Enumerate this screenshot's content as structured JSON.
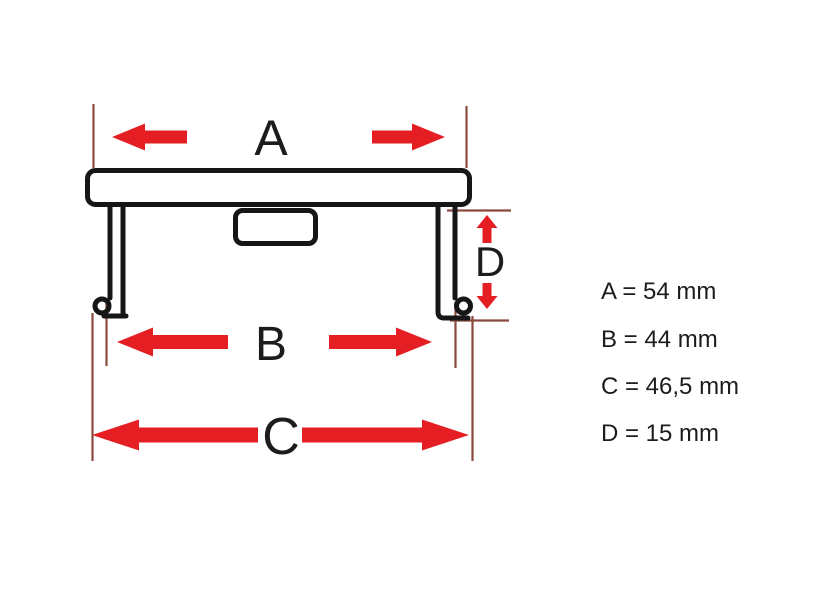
{
  "diagram": {
    "title": "wheel-center-cap-dimension-diagram",
    "dimension_labels": {
      "a": "A",
      "b": "B",
      "c": "C",
      "d": "D"
    },
    "colors": {
      "arrow_red": "#e51e23",
      "reference_line_brown": "#8a4a3e",
      "outline_black": "#161616",
      "text": "#1c1c1c",
      "background": "#ffffff"
    }
  },
  "legend": {
    "lines": [
      {
        "text": "A = 54 mm"
      },
      {
        "text": "B = 44 mm"
      },
      {
        "text": "C = 46,5 mm"
      },
      {
        "text": "D = 15 mm"
      }
    ]
  },
  "dimensions_mm": {
    "A": "54",
    "B": "44",
    "C": "46,5",
    "D": "15"
  }
}
